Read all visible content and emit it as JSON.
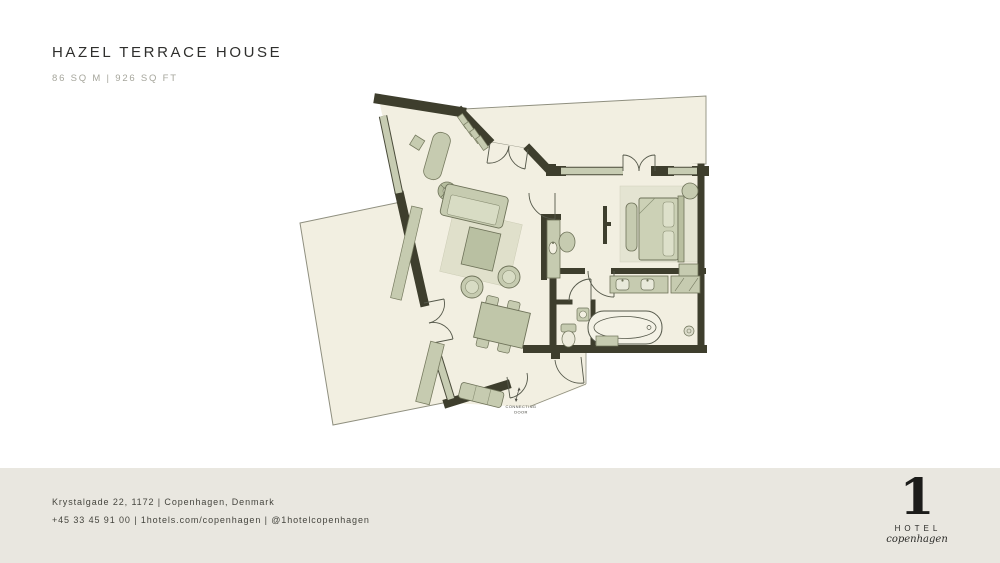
{
  "header": {
    "title": "HAZEL TERRACE HOUSE",
    "subtitle": "86 SQ M | 926 SQ FT"
  },
  "floorplan": {
    "connecting_door_line1": "CONNECTING",
    "connecting_door_line2": "DOOR"
  },
  "footer": {
    "address": "Krystalgade 22, 1172 | Copenhagen, Denmark",
    "contact": "+45 33 45 91 00 | 1hotels.com/copenhagen | @1hotelcopenhagen"
  },
  "logo": {
    "numeral": "1",
    "hotel": "HOTEL",
    "city": "copenhagen"
  },
  "colors": {
    "wall": "#3e3e2d",
    "floor": "#f2efe1",
    "window": "#c7ccb2",
    "furniture": "#c6cbb0",
    "rug": "#e0e0cb",
    "footer_band": "#e9e7e0",
    "title_text": "#2f2f2d",
    "muted_text": "#a6a69c"
  }
}
